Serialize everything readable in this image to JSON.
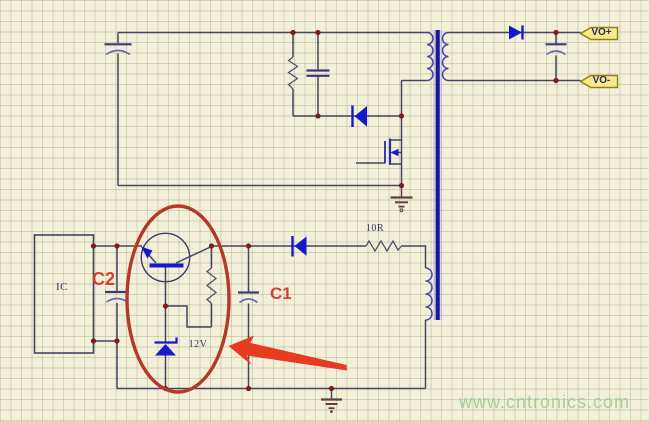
{
  "schematic": {
    "type": "flyback-power-supply-circuit",
    "labels": {
      "ic": "IC",
      "resistor_value": "10R",
      "zener_value": "12V",
      "cap_annotation_1": "C1",
      "cap_annotation_2": "C2"
    },
    "output_tags": {
      "positive": "VO+",
      "negative": "VO-"
    },
    "watermark": "www.cntronics.com",
    "colors": {
      "background": "#f3f0da",
      "grid_line": "#d9d5bc",
      "wire": "#45455e",
      "component_blue": "#1717cd",
      "transformer_core": "#18189b",
      "junction_dot": "#7c1f1a",
      "ground": "#5e4438",
      "annotation_red": "#ce4434",
      "arrow_red": "#e63c22",
      "ellipse_red": "#b5382b",
      "tag_fill": "#f6eb87",
      "tag_border": "#8f7f1f",
      "watermark_green": "#97cc8e"
    },
    "components": [
      "input-electrolytic-capacitor",
      "snubber-resistor",
      "snubber-capacitor",
      "clamp-diode",
      "power-mosfet",
      "transformer-core",
      "transformer-primary-winding",
      "transformer-secondary-winding",
      "transformer-auxiliary-winding",
      "output-rectifier-diode",
      "output-electrolytic-capacitor",
      "control-ic-box",
      "capacitor-c2",
      "transistor",
      "feedback-resistor",
      "zener-diode-12v",
      "auxiliary-diode",
      "resistor-10r",
      "power-ground-top",
      "power-ground-bottom"
    ],
    "annotations": {
      "ellipse": "red-ellipse-highlight",
      "arrow": "red-arrow-pointer"
    }
  }
}
